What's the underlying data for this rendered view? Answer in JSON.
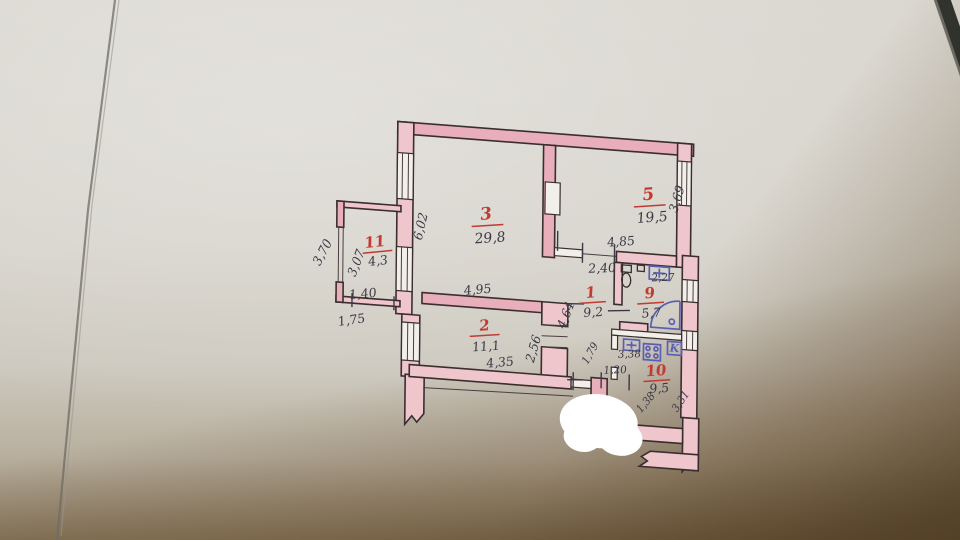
{
  "rooms": [
    {
      "number": "3",
      "area": "29,8"
    },
    {
      "number": "5",
      "area": "19,5"
    },
    {
      "number": "11",
      "area": "4,3"
    },
    {
      "number": "1",
      "area": "9,2"
    },
    {
      "number": "9",
      "area": "5,7"
    },
    {
      "number": "2",
      "area": "11,1"
    },
    {
      "number": "10",
      "area": "9,5"
    }
  ],
  "dims": {
    "d6_02": "6,02",
    "d3_69": "3,69",
    "d4_85": "4,85",
    "d2_40": "2,40",
    "d2_27": "2,27",
    "d4_95": "4,95",
    "d4_64": "4,64",
    "d2_56": "2,56",
    "d4_35": "4,35",
    "d1_79": "1,79",
    "d3_38": "3,38",
    "d1_20": "1,20",
    "d1_38": "1,38",
    "d3_31": "3,31",
    "d3_70": "3,70",
    "d3_07": "3,07",
    "d1_40": "1,40",
    "d1_75": "1,75"
  },
  "symbols": {
    "kitchen_marker": "K"
  },
  "colors": {
    "wall_fill": "#eec6cc",
    "wall_fill_dark": "#e8aeba",
    "ink": "#3a2e2f",
    "dimension_ink": "#3c3846",
    "room_label_red": "#c13b32",
    "fixture_blue": "#5b5fb0",
    "paper_light": "#dad7d0",
    "paper_shadow": "#6b5638",
    "correction_white": "#ffffff"
  }
}
